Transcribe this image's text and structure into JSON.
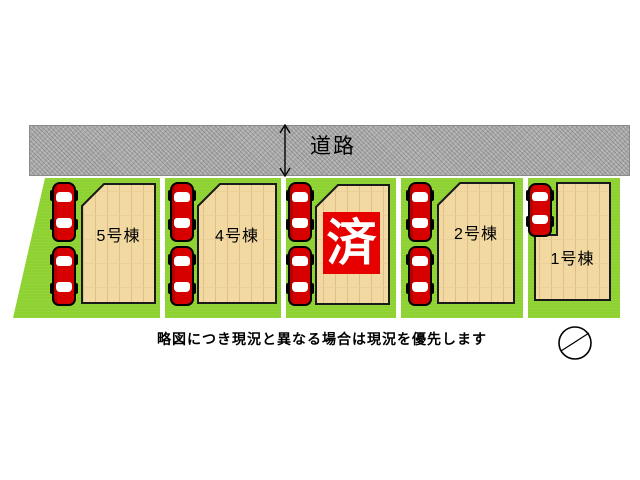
{
  "road": {
    "label": "道路",
    "width_arrow_icon": "double-vertical-arrow",
    "color": "#acacac"
  },
  "lots": [
    {
      "name": "lot-5",
      "label": "5号棟",
      "car_count": 2,
      "sold": false
    },
    {
      "name": "lot-4",
      "label": "4号棟",
      "car_count": 2,
      "sold": false
    },
    {
      "name": "lot-3",
      "sold_badge": "済",
      "car_count": 2,
      "sold": true
    },
    {
      "name": "lot-2",
      "label": "2号棟",
      "car_count": 2,
      "sold": false
    },
    {
      "name": "lot-1",
      "label": "1号棟",
      "car_count": 1,
      "sold": false
    }
  ],
  "footer": {
    "disclaimer": "略図につき現況と異なる場合は現況を優先します"
  },
  "icons": {
    "compass": "north-arrow-icon",
    "car": "car-icon"
  },
  "colors": {
    "grass": "#8dd231",
    "building": "#f1d9a1",
    "car_red": "#d60000",
    "sold_bg": "#e60000",
    "sold_fg": "#ffffff"
  }
}
